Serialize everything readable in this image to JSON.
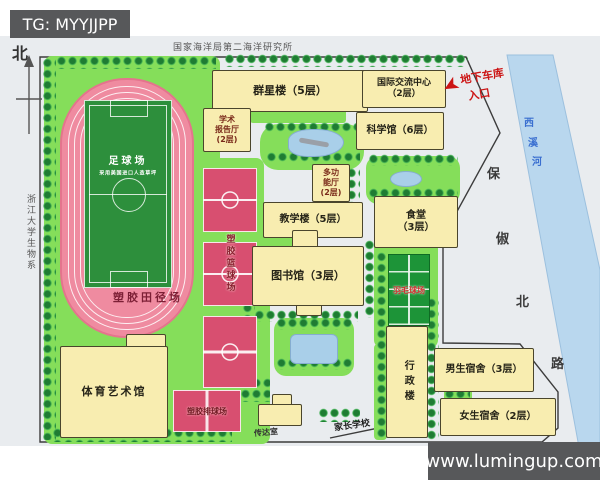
{
  "watermarks": {
    "telegram": "TG: MYYJJPP",
    "site": "www.lumingup.com"
  },
  "map": {
    "compass_north": "北",
    "north_institute": "国家海洋局第二海洋研究所",
    "west_neighbor": "浙江大学生物系",
    "road": {
      "name": "保俶北路",
      "chars": [
        "保",
        "俶",
        "北",
        "路"
      ]
    },
    "river": {
      "name": "西溪河",
      "chars": [
        "西",
        "溪",
        "河"
      ]
    },
    "garage": {
      "line1": "地下车库",
      "line2": "入口"
    },
    "buildings": {
      "qunxing": "群星楼（5层）",
      "lecture_hall": {
        "l1": "学术",
        "l2": "报告厅",
        "l3": "(2层)"
      },
      "intl_center": {
        "l1": "国际交流中心",
        "l2": "（2层）"
      },
      "science": "科学馆（6层）",
      "multi_hall": {
        "l1": "多功",
        "l2": "能厅",
        "l3": "(2层)"
      },
      "teaching": "教学楼（5层）",
      "canteen": {
        "l1": "食堂",
        "l2": "（3层）"
      },
      "library": "图书馆（3层）",
      "admin": "行政楼",
      "male_dorm": "男生宿舍（3层）",
      "female_dorm": "女生宿舍（2层）",
      "sports_hall": "体育艺术馆",
      "gatehouse": "传达室",
      "parents_school": "家长学校"
    },
    "sports": {
      "football": "足球场",
      "football_sub": "采用美国进口人造草坪",
      "track": "塑胶田径场",
      "basketball": "塑胶篮球场",
      "badminton": "羽毛球场",
      "volleyball": "塑胶排球场"
    },
    "colors": {
      "lawn": "#85de5a",
      "track_pink": "#ef8ba0",
      "field_green": "#2d8f3c",
      "court_red": "#d84f70",
      "building_cream": "#f8edb0",
      "river_blue": "#a9cfe9",
      "badminton_green": "#1d9438",
      "accent_red": "#cc1414",
      "watermark_gray": "#57585a"
    }
  }
}
